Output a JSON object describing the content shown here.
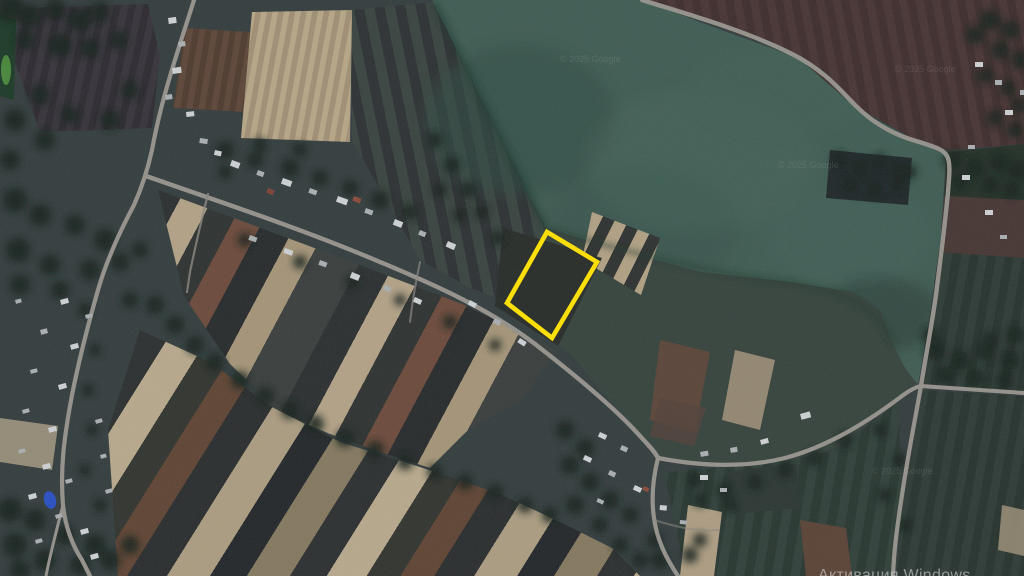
{
  "map": {
    "parcel_highlight_color": "#ffe100"
  },
  "watermarks": {
    "windows_activation": "Активация Windows",
    "imagery_copyright": "© 2025 Google"
  }
}
